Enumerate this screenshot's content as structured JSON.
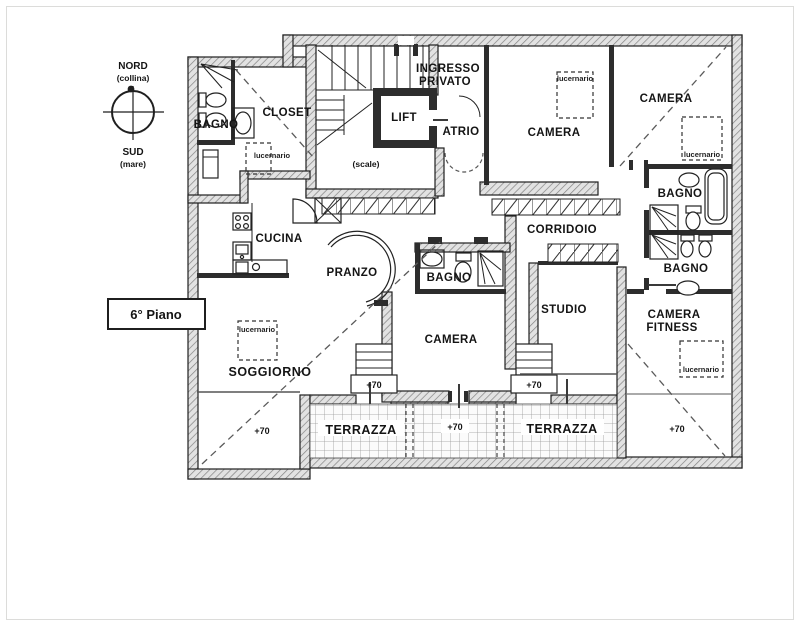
{
  "floor_label": "6° Piano",
  "compass": {
    "north": "NORD",
    "north_note": "(collina)",
    "south": "SUD",
    "south_note": "(mare)"
  },
  "rooms": {
    "bagno_nw": "BAGNO",
    "closet": "CLOSET",
    "ingresso_1": "INGRESSO",
    "ingresso_2": "PRIVATO",
    "lift": "LIFT",
    "atrio": "ATRIO",
    "scale": "(scale)",
    "cucina": "CUCINA",
    "pranzo": "PRANZO",
    "bagno_center": "BAGNO",
    "camera_top_center": "CAMERA",
    "camera_top_right": "CAMERA",
    "corridoio": "CORRIDOIO",
    "bagno_right_upper": "BAGNO",
    "bagno_right_lower": "BAGNO",
    "studio": "STUDIO",
    "camera_fitness_1": "CAMERA",
    "camera_fitness_2": "FITNESS",
    "soggiorno": "SOGGIORNO",
    "camera_bottom_center": "CAMERA",
    "terrazza_west": "TERRAZZA",
    "terrazza_east": "TERRAZZA"
  },
  "annotations": {
    "skylight_label": "lucernario",
    "level_marker": "+70"
  },
  "colors": {
    "ink": "#1f1f1f",
    "wall_fill": "#e2e2e2",
    "paper": "#ffffff"
  }
}
